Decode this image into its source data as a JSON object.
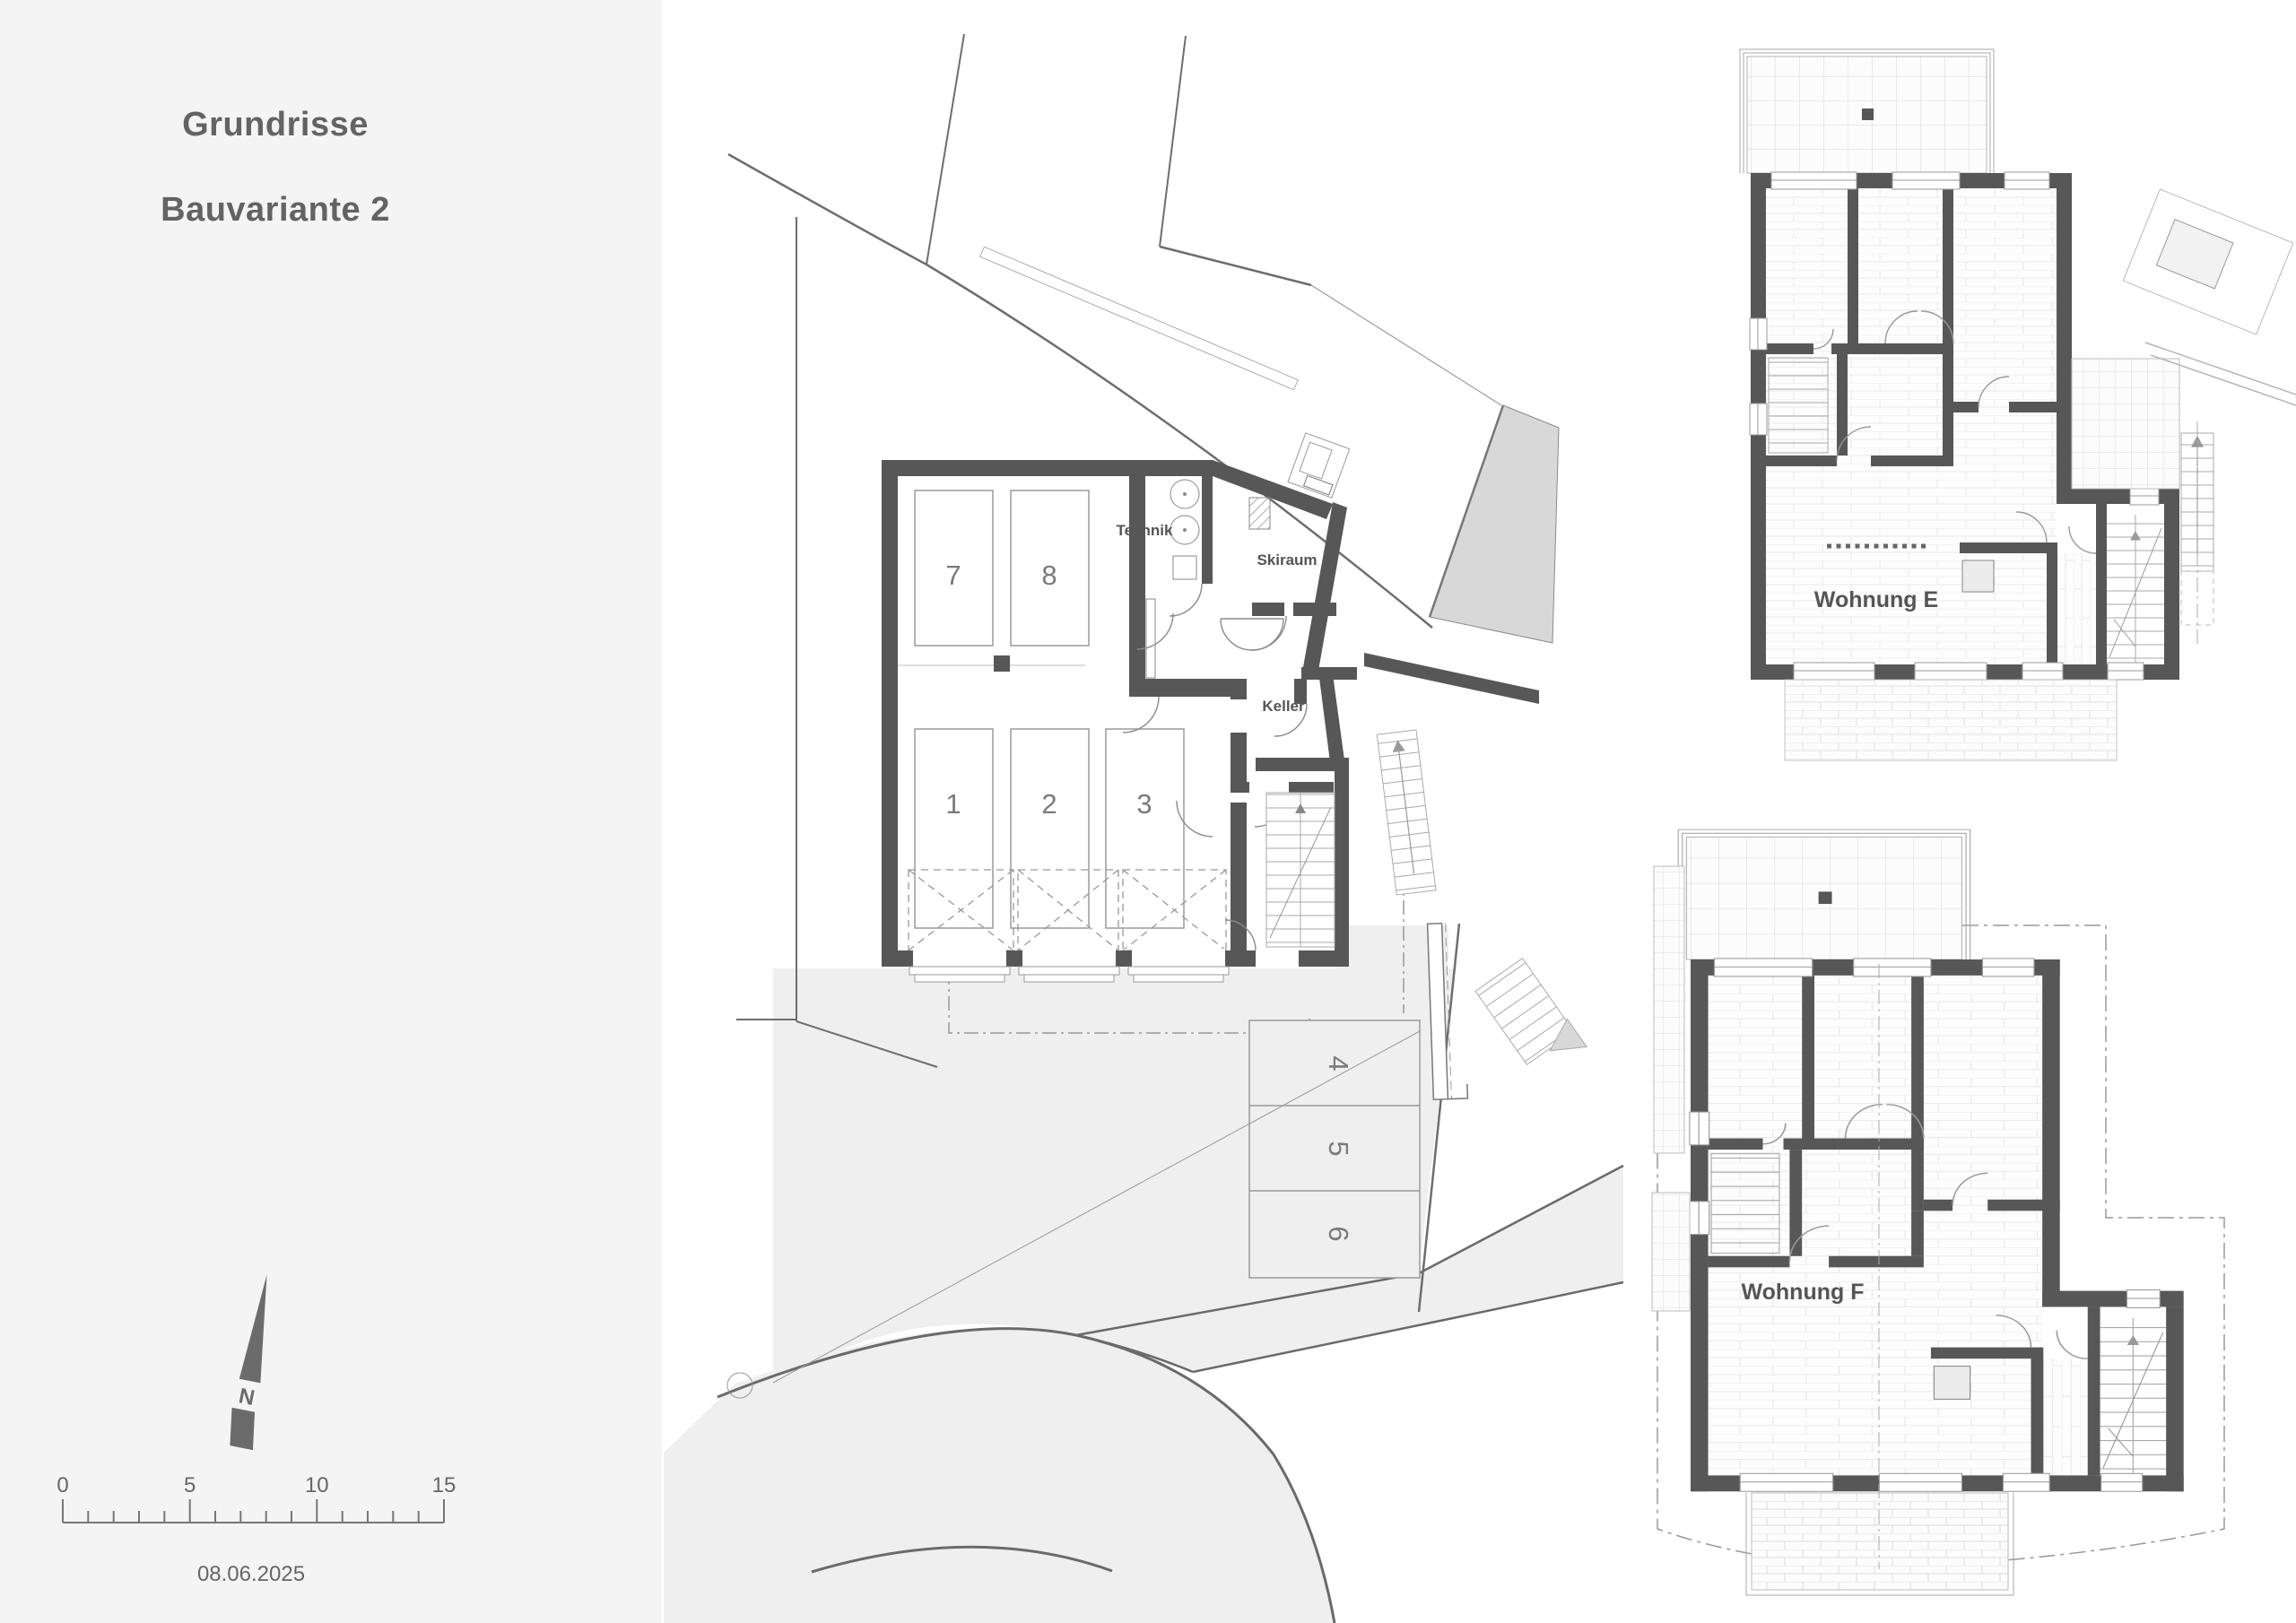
{
  "sheet": {
    "title_line1": "Grundrisse",
    "title_line2": "Bauvariante 2",
    "date": "08.06.2025"
  },
  "north_arrow": {
    "label": "N"
  },
  "scale_bar": {
    "tick_labels": [
      "0",
      "5",
      "10",
      "15"
    ]
  },
  "site_plan": {
    "garage": {
      "room_labels": {
        "technik": "Technik",
        "skiraum": "Skiraum",
        "keller": "Keller"
      },
      "parking_upper": [
        "7",
        "8"
      ],
      "parking_lower": [
        "1",
        "2",
        "3"
      ]
    },
    "outdoor_parking": [
      "4",
      "5",
      "6"
    ]
  },
  "apartments": {
    "e_label": "Wohnung E",
    "f_label": "Wohnung F"
  },
  "colors": {
    "wall": "#575757",
    "thin_line": "#999999",
    "boundary_line": "#6a6a6a",
    "paved_area": "#efefef",
    "ramp_fill": "#d8d8d8",
    "title_text": "#636363",
    "label_text": "#555555",
    "number_text": "#7a7a7a",
    "sidebar_bg": "#f4f4f4"
  }
}
